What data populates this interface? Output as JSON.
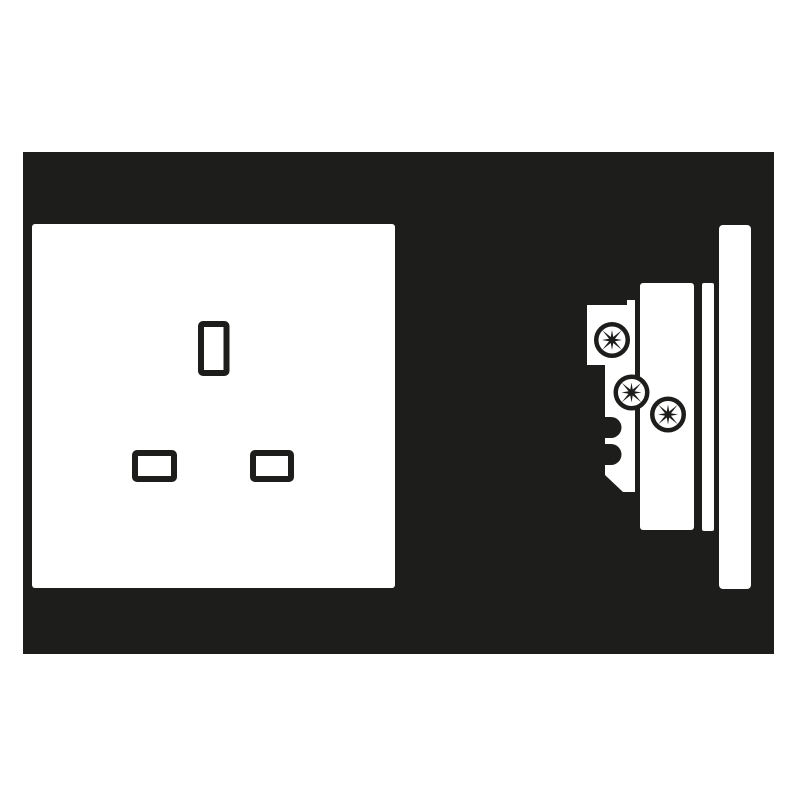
{
  "colors": {
    "ink": "#1d1d1b",
    "paper": "#ffffff"
  },
  "canvas": {
    "width": 800,
    "height": 800
  },
  "panel": {
    "x": 23,
    "y": 152,
    "width": 751,
    "height": 502
  },
  "front_view": {
    "faceplate": {
      "x": 32,
      "y": 224,
      "width": 363,
      "height": 364,
      "radius": 3
    },
    "slot_stroke": 6,
    "slot_radius": 2,
    "slots": [
      {
        "name": "earth-pin-slot",
        "x": 198,
        "y": 321,
        "width": 31.5,
        "height": 55
      },
      {
        "name": "live-pin-slot",
        "x": 132,
        "y": 450,
        "width": 45,
        "height": 32
      },
      {
        "name": "neutral-pin-slot",
        "x": 250,
        "y": 450,
        "width": 44,
        "height": 32
      }
    ]
  },
  "side_view": {
    "back_body_path": "M587,305 L627,305 L627,300 L635,300 L635,492 L623,492 L605,475 L605,465 L611,465 A10.5,10.5 0 0 0 611,444 L605,444 L605,438 L611,438 A10.5,10.5 0 0 0 611,417 L605,417 L605,365 L587,365 Z",
    "socket_body": {
      "x": 640,
      "y": 283,
      "width": 54,
      "height": 247,
      "radius": 3
    },
    "spacer": {
      "x": 702,
      "y": 283,
      "width": 12,
      "height": 248,
      "radius": 2
    },
    "faceplate_profile": {
      "x": 719,
      "y": 225,
      "width": 32,
      "height": 364,
      "radius": 4
    },
    "screws": {
      "style": {
        "outer_radius": 18,
        "ring_stroke": 4.5,
        "star_long": 13.8,
        "star_short": 10,
        "star_valley": 3.2
      },
      "positions": [
        {
          "cx": 612,
          "cy": 340
        },
        {
          "cx": 631.5,
          "cy": 392.5
        },
        {
          "cx": 668,
          "cy": 414.5
        }
      ]
    }
  }
}
